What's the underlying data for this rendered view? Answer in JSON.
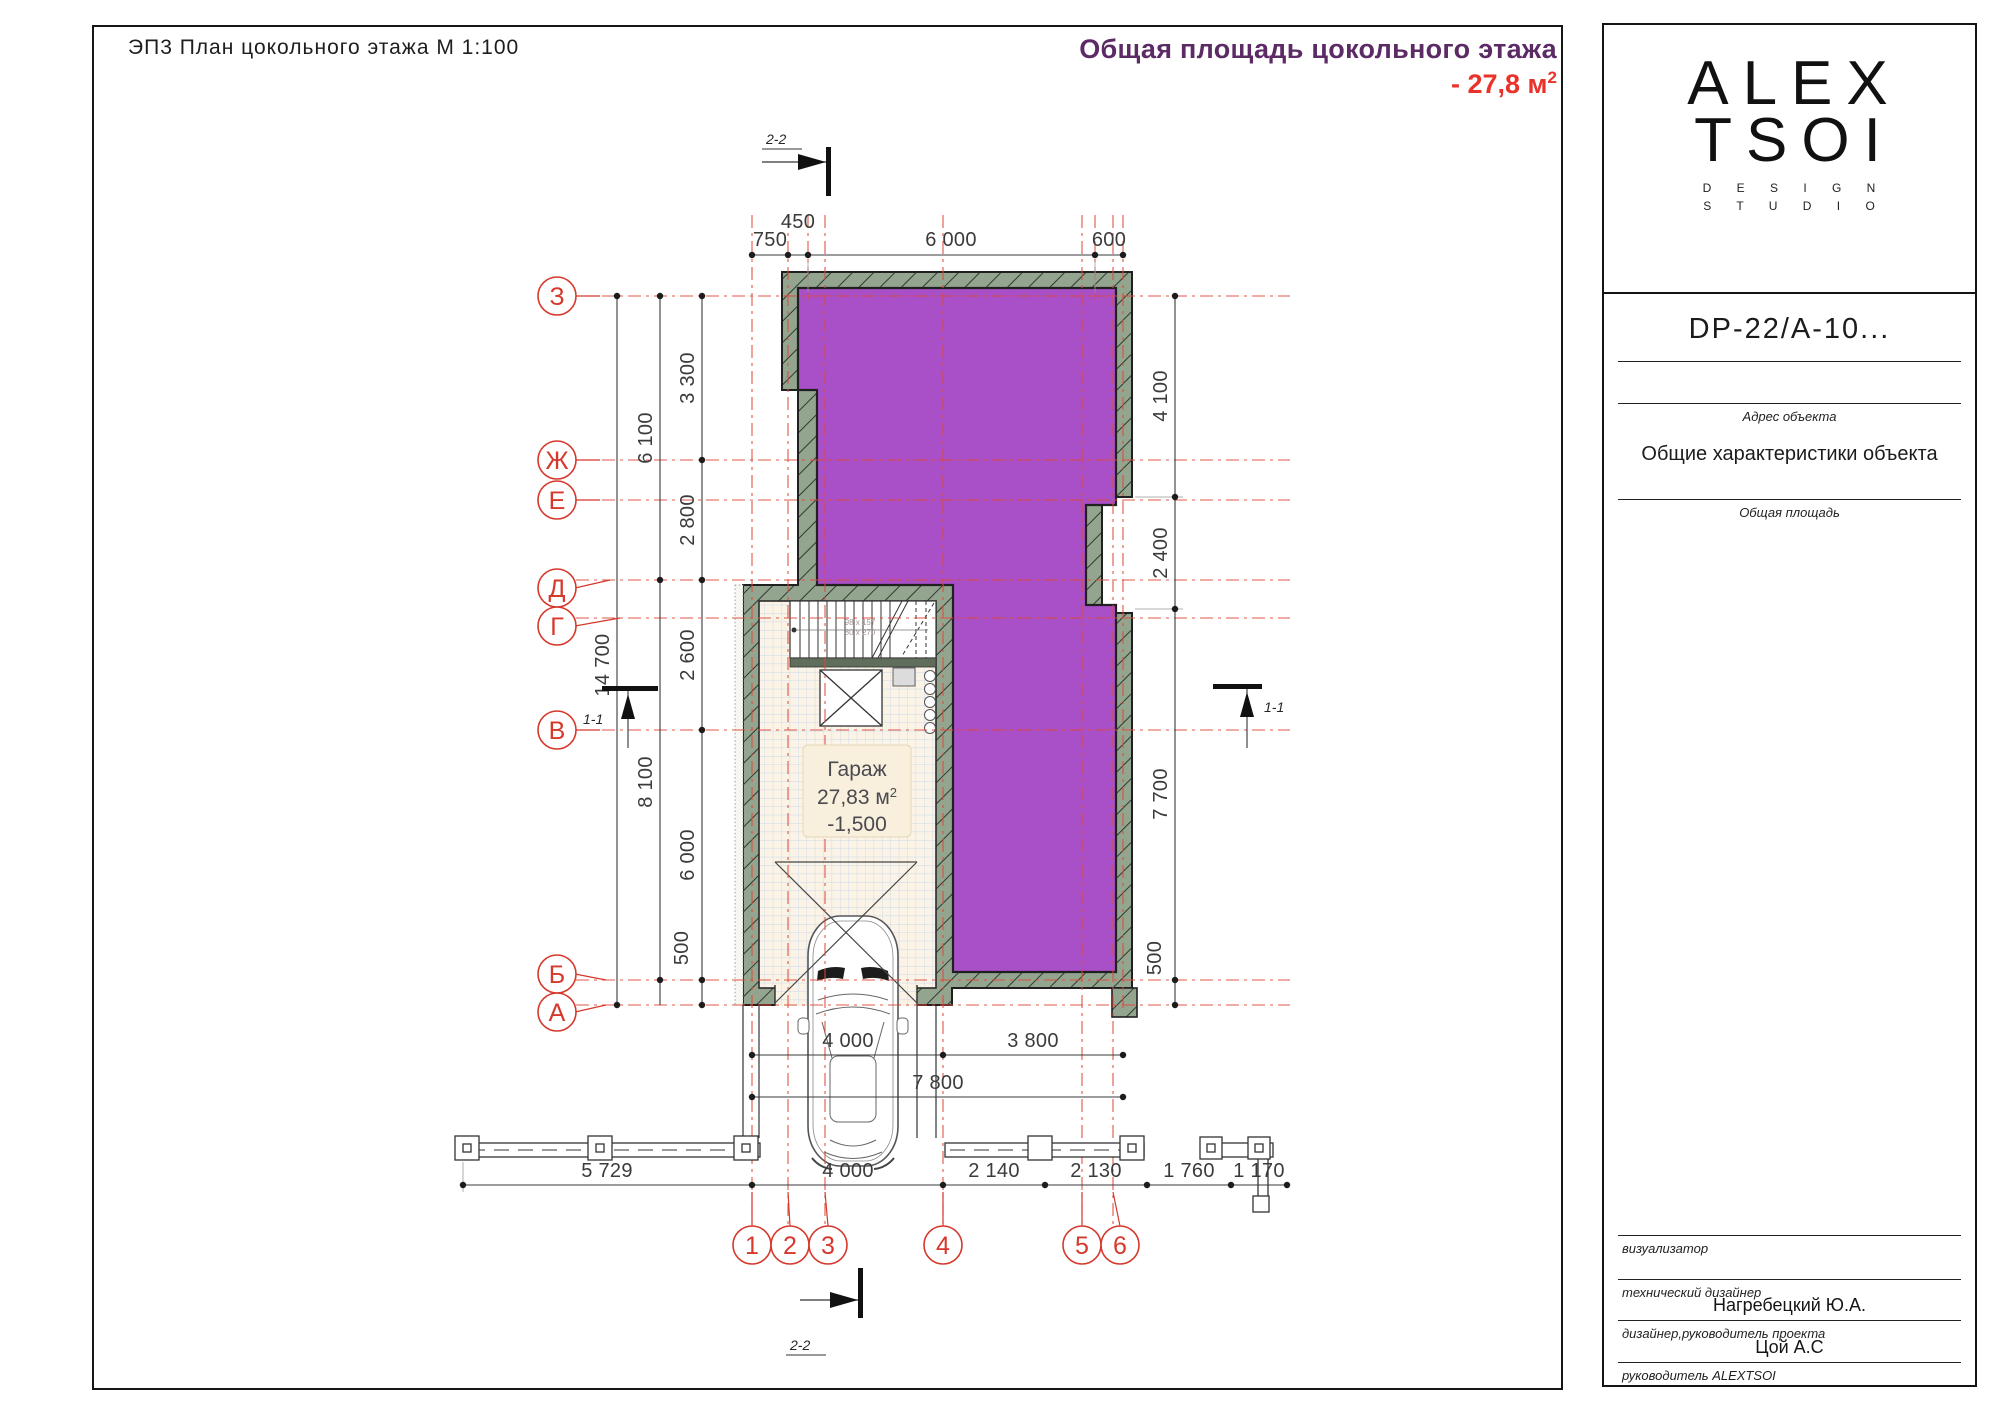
{
  "sheet": {
    "title": "ЭП3   План цокольного этажа   М 1:100",
    "area_summary": {
      "caption": "Общая площадь цокольного этажа",
      "value": "- 27,8 м",
      "sup": "2"
    }
  },
  "plan": {
    "room": {
      "name": "Гараж",
      "area": "27,83 м",
      "area_sup": "2",
      "level": "-1,500"
    },
    "stairs": {
      "note1": "98 x 157",
      "note2": "80 x 270"
    },
    "axes_letters": [
      "З",
      "Ж",
      "Е",
      "Д",
      "Г",
      "В",
      "Б",
      "А"
    ],
    "axes_numbers": [
      "1",
      "2",
      "3",
      "4",
      "5",
      "6"
    ],
    "sections": {
      "horizontal": "1-1",
      "vertical": "2-2"
    },
    "dims": {
      "top": [
        "750",
        "450",
        "6 000",
        "600"
      ],
      "left_outer": "14 700",
      "left_mid": [
        "6 100",
        "8 100"
      ],
      "left_inner": [
        "3 300",
        "2 800",
        "2 600",
        "6 000",
        "500"
      ],
      "right": [
        "4 100",
        "2 400",
        "7 700",
        "500"
      ],
      "below_top": [
        "4 000",
        "3 800"
      ],
      "below_mid": "7 800",
      "bottom": [
        "5 729",
        "4 000",
        "2 140",
        "2 130",
        "1 760",
        "1 170"
      ]
    }
  },
  "titleblock": {
    "logo": {
      "line1": "ALEX",
      "line2": "TSOI",
      "sub1": "D E S I G N",
      "sub2": "S T U D I O"
    },
    "doc_code": "DP-22/А-10...",
    "address_label": "Адрес объекта",
    "characteristics_title": "Общие характеристики объекта",
    "total_area_label": "Общая площадь",
    "signatures": [
      {
        "label": "визуализатор",
        "value": ""
      },
      {
        "label": "технический дизайнер",
        "value": "Нагребецкий Ю.А."
      },
      {
        "label": "дизайнер,руководитель проекта",
        "value": "Цой А.С"
      },
      {
        "label": "руководитель ALEXTSOI",
        "value": ""
      }
    ]
  },
  "colors": {
    "purple_room": "#a94fc8",
    "wall_green": "#93a48f",
    "axis_red": "#d6382c",
    "floor_cream": "#faf3e6",
    "tile_grid": "#ccd9ec",
    "label_bg": "#f8efdc",
    "caption_purple": "#5c2b66",
    "caption_red": "#e8322a"
  }
}
